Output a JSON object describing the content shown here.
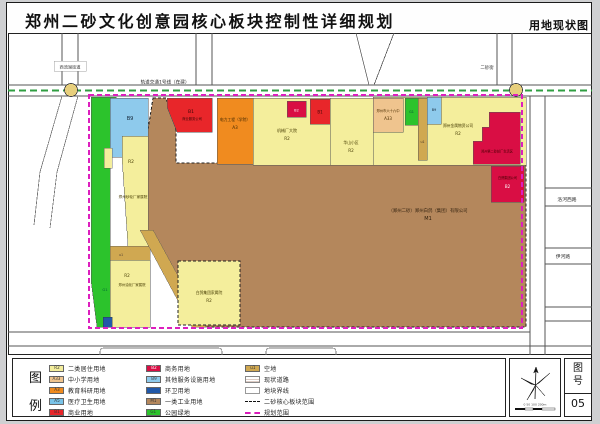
{
  "header": {
    "title": "郑州二砂文化创意园核心板块控制性详细规划",
    "right_label": "用地现状图"
  },
  "map": {
    "metro_label": "轨道交通1号线（在建）",
    "district_label": "西流湖街道",
    "street_top_right": "二砂街",
    "road_right_1": "洛河西路",
    "road_right_2": "伊河路",
    "parcels": {
      "m1_name": "（郑州二砂）郑州白鸽（集团）有限公司",
      "m1_code": "M1",
      "b9_west": "B9",
      "r2_west_code": "R2",
      "r2_west_name": "郑州砂轮厂家属院",
      "r2_sw_code": "R2",
      "r2_sw_name": "郑州油化厂家属院",
      "g1_west": "G1",
      "u1_west": "u1",
      "r2_center_name": "白鸽集团家属院",
      "r2_center_code": "R2",
      "b1_north_code": "B1",
      "b1_north_name": "商业服务公司",
      "a3_name": "电力工程（学院）",
      "a3_code": "A3",
      "r2_a_name": "机械厂大院",
      "r2_a_code": "R2",
      "b2_small_code": "B2",
      "b1_small_code": "B1",
      "r2_b_name": "华山小区",
      "r2_b_code": "R2",
      "a33_name": "郑州市六十六中",
      "a33_code": "A33",
      "g1_small": "G1",
      "u1_small": "u1",
      "b9_small": "B9",
      "r2_c_name": "郑州金属物资公司",
      "r2_c_code": "R2",
      "b2_east_text": "郑州第二砂轮厂生活区",
      "b2_east2_name": "白鸽集团公司",
      "b2_east2_code": "B2"
    }
  },
  "legend": {
    "title_chars": [
      "图",
      "例"
    ],
    "col1": [
      {
        "code": "R2",
        "label": "二类居住用地",
        "color": "r2"
      },
      {
        "code": "A33",
        "label": "中小学用地",
        "color": "a33"
      },
      {
        "code": "A3",
        "label": "教育科研用地",
        "color": "a3"
      },
      {
        "code": "A5",
        "label": "医疗卫生用地",
        "color": "a5"
      },
      {
        "code": "B1",
        "label": "商业用地",
        "color": "b1"
      }
    ],
    "col2": [
      {
        "code": "B2",
        "label": "商务用地",
        "color": "b2"
      },
      {
        "code": "B9",
        "label": "其他服务设施用地",
        "color": "b9"
      },
      {
        "code": "",
        "label": "环卫用地",
        "color": "sanitation"
      },
      {
        "code": "M1",
        "label": "一类工业用地",
        "color": "m1"
      },
      {
        "code": "G1",
        "label": "公园绿地",
        "color": "g1"
      }
    ],
    "col3": [
      {
        "code": "u1",
        "label": "空地",
        "color": "vacant"
      },
      {
        "label": "现状道路"
      },
      {
        "label": "地块界线"
      },
      {
        "label": "二砂核心板块范围"
      },
      {
        "label": "规划范围"
      }
    ]
  },
  "titleblock": {
    "fig_label_top": "图",
    "fig_label_bottom": "号",
    "fig_no": "05",
    "scale_text": "0  50  100   200m"
  },
  "colors": {
    "r2": "#f4ee9c",
    "a33": "#efc48e",
    "a3": "#f08b1f",
    "a5": "#79c3e8",
    "b1": "#e8262a",
    "b2": "#d90e44",
    "b9": "#8ecaec",
    "sanitation": "#2158a8",
    "m1": "#b4875c",
    "g1": "#2cc32c",
    "vacant": "#d0a851",
    "boundary_magenta": "#dd1fbe",
    "rail_green": "#2f9e41",
    "roundabout": "#e7cf7c"
  }
}
